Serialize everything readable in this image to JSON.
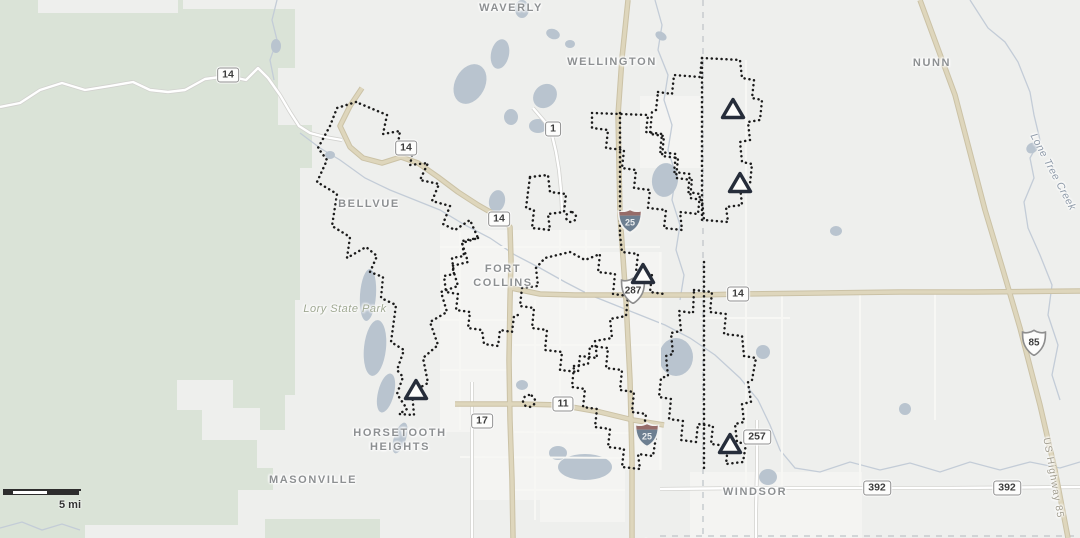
{
  "map": {
    "colors": {
      "background": "#eeefed",
      "green": "#dae3d7",
      "urban": "#f4f4f2",
      "water": "#b9c4cf",
      "creek": "#c3ccd7",
      "road_major_fill": "#ded6bc",
      "road_major_casing": "#cbc2a6",
      "road_white_fill": "#ffffff",
      "road_white_casing": "#d2d2cf",
      "road_faint": "#f7f7f4",
      "boundary_dots": "#1b1b1b",
      "county_line": "#c7cbcf",
      "marker_stroke": "#262d3a",
      "marker_fill": "#fcfcfa",
      "interstate_red": "#966c69",
      "interstate_blue": "#6d7f91"
    },
    "places": [
      {
        "text": "WAVERLY",
        "x": 511,
        "y": 8,
        "kind": "town"
      },
      {
        "text": "WELLINGTON",
        "x": 612,
        "y": 62,
        "kind": "town"
      },
      {
        "text": "NUNN",
        "x": 932,
        "y": 63,
        "kind": "town"
      },
      {
        "text": "BELLVUE",
        "x": 369,
        "y": 204,
        "kind": "town"
      },
      {
        "text": "FORT COLLINS",
        "x": 503,
        "y": 276,
        "kind": "town",
        "lines": [
          "FORT",
          "COLLINS"
        ]
      },
      {
        "text": "Lory State Park",
        "x": 345,
        "y": 309,
        "kind": "park"
      },
      {
        "text": "HORSETOOTH HEIGHTS",
        "x": 400,
        "y": 440,
        "kind": "town",
        "lines": [
          "HORSETOOTH",
          "HEIGHTS"
        ]
      },
      {
        "text": "MASONVILLE",
        "x": 313,
        "y": 480,
        "kind": "town"
      },
      {
        "text": "WINDSOR",
        "x": 755,
        "y": 492,
        "kind": "town"
      },
      {
        "text": "Lone Tree Creek",
        "x": 1053,
        "y": 172,
        "kind": "water",
        "rot": 62
      },
      {
        "text": "US Highway 85",
        "x": 1053,
        "y": 478,
        "kind": "road",
        "rot": 80
      }
    ],
    "shields": [
      {
        "type": "state",
        "label": "14",
        "x": 228,
        "y": 75
      },
      {
        "type": "state",
        "label": "14",
        "x": 406,
        "y": 148
      },
      {
        "type": "state",
        "label": "14",
        "x": 499,
        "y": 219
      },
      {
        "type": "state",
        "label": "14",
        "x": 738,
        "y": 294
      },
      {
        "type": "state",
        "label": "1",
        "x": 553,
        "y": 129
      },
      {
        "type": "state",
        "label": "17",
        "x": 482,
        "y": 421
      },
      {
        "type": "state",
        "label": "11",
        "x": 563,
        "y": 404
      },
      {
        "type": "state",
        "label": "257",
        "x": 757,
        "y": 437
      },
      {
        "type": "state",
        "label": "392",
        "x": 877,
        "y": 488
      },
      {
        "type": "state",
        "label": "392",
        "x": 1007,
        "y": 488
      },
      {
        "type": "us",
        "label": "287",
        "x": 619,
        "y": 276
      },
      {
        "type": "us",
        "label": "85",
        "x": 1020,
        "y": 328
      },
      {
        "type": "interstate",
        "label": "25",
        "x": 616,
        "y": 207
      },
      {
        "type": "interstate",
        "label": "25",
        "x": 633,
        "y": 421
      },
      {
        "type": "interstate",
        "label": "25",
        "x": 632,
        "y": 536
      }
    ],
    "markers": [
      {
        "x": 720,
        "y": 97
      },
      {
        "x": 727,
        "y": 171
      },
      {
        "x": 630,
        "y": 262
      },
      {
        "x": 403,
        "y": 378
      },
      {
        "x": 717,
        "y": 432
      }
    ],
    "green_areas": [
      {
        "points": "0,0 295,0 295,68 278,68 278,125 312,125 312,168 300,168 300,300 295,300 295,395 285,395 285,430 257,430 257,468 273,468 273,490 238,490 238,525 85,525 85,538 0,538"
      },
      {
        "points": "265,519 380,519 380,538 265,538"
      }
    ],
    "gray_patches": [
      {
        "x": 38,
        "y": 0,
        "w": 140,
        "h": 13
      },
      {
        "x": 183,
        "y": 0,
        "w": 112,
        "h": 9
      },
      {
        "x": 177,
        "y": 380,
        "w": 56,
        "h": 30
      },
      {
        "x": 202,
        "y": 408,
        "w": 58,
        "h": 32
      }
    ],
    "urban_areas": [
      {
        "points": "440,230 600,230 600,252 662,252 662,470 625,470 625,522 540,522 540,500 470,500 470,432 440,432"
      },
      {
        "points": "640,96 700,96 700,168 640,168"
      },
      {
        "points": "690,472 862,472 862,538 690,538"
      }
    ],
    "water": [
      [
        500,
        54,
        9,
        15,
        12
      ],
      [
        522,
        9,
        7,
        9,
        0
      ],
      [
        470,
        84,
        15,
        21,
        28
      ],
      [
        545,
        96,
        11,
        13,
        42
      ],
      [
        511,
        117,
        7,
        8,
        0
      ],
      [
        538,
        126,
        9,
        7,
        0
      ],
      [
        553,
        34,
        7,
        5,
        20
      ],
      [
        570,
        44,
        5,
        4,
        0
      ],
      [
        497,
        201,
        8,
        11,
        12
      ],
      [
        368,
        295,
        8,
        26,
        4
      ],
      [
        375,
        348,
        11,
        28,
        6
      ],
      [
        386,
        393,
        8,
        20,
        14
      ],
      [
        400,
        438,
        6,
        16,
        18
      ],
      [
        665,
        180,
        13,
        17,
        8
      ],
      [
        676,
        357,
        17,
        19,
        0
      ],
      [
        763,
        352,
        7,
        7,
        0
      ],
      [
        522,
        385,
        6,
        5,
        0
      ],
      [
        585,
        467,
        27,
        13,
        0
      ],
      [
        558,
        453,
        9,
        7,
        0
      ],
      [
        768,
        477,
        9,
        8,
        0
      ],
      [
        905,
        409,
        6,
        6,
        0
      ],
      [
        836,
        231,
        6,
        5,
        0
      ],
      [
        1032,
        148,
        5,
        6,
        55
      ],
      [
        276,
        46,
        5,
        7,
        0
      ],
      [
        661,
        36,
        6,
        4,
        30
      ],
      [
        330,
        155,
        5,
        4,
        0
      ]
    ],
    "creeks": [
      {
        "pts": "970,0 988,28 1005,42 1018,62 1030,92 1034,115 1040,140 1030,158 1034,178 1024,202 1028,228 1040,255 1052,285 1048,315 1058,345 1052,375 1060,400"
      },
      {
        "pts": "655,0 662,25 658,50 668,75 664,100 672,125 668,150 676,175 672,200 680,225 676,250 684,275 680,300"
      },
      {
        "pts": "300,133 320,148 340,160 365,178 390,190 415,200 440,210 465,225 490,238 515,255 540,268 565,282 590,295 615,305 640,315 665,325 690,338 715,355 740,378 758,400 770,425 780,450 795,468 820,472 850,462 880,470 910,463 940,472 970,462 1000,470 1030,462 1060,468 1080,462"
      },
      {
        "pts": "277,0 272,20 277,40 270,60 274,80"
      },
      {
        "pts": "0,528 22,522 42,530 62,524 80,530"
      }
    ],
    "roads": [
      {
        "style": "faint",
        "pts": "460,232 460,430"
      },
      {
        "style": "faint",
        "pts": "535,300 535,520"
      },
      {
        "style": "faint",
        "pts": "560,230 560,402"
      },
      {
        "style": "faint",
        "pts": "586,230 586,310"
      },
      {
        "style": "faint",
        "pts": "660,252 660,470"
      },
      {
        "style": "faint",
        "pts": "440,247 660,247"
      },
      {
        "style": "faint",
        "pts": "440,320 508,320"
      },
      {
        "style": "faint",
        "pts": "514,345 660,345"
      },
      {
        "style": "faint",
        "pts": "440,370 508,370"
      },
      {
        "style": "faint",
        "pts": "514,432 630,433"
      },
      {
        "style": "faint",
        "pts": "460,457 630,458"
      },
      {
        "style": "faint",
        "pts": "514,490 625,490"
      },
      {
        "style": "faint",
        "pts": "746,60 746,290"
      },
      {
        "style": "faint",
        "pts": "746,300 746,486"
      },
      {
        "style": "faint",
        "pts": "782,296 782,486"
      },
      {
        "style": "faint",
        "pts": "860,293 860,486"
      },
      {
        "style": "faint",
        "pts": "700,318 790,318"
      },
      {
        "style": "faint",
        "pts": "935,293 935,420"
      },
      {
        "style": "white",
        "pts": "0,107 20,103 40,90 62,83 85,90 110,86 133,82 150,90 168,92 185,90 205,79 228,76 246,80 258,68 268,78 280,95 290,112 299,126 310,133 325,137 342,140"
      },
      {
        "style": "white",
        "pts": "533,108 545,122 552,135 556,152 559,170 561,190 562,210"
      },
      {
        "style": "white",
        "pts": "472,382 472,538"
      },
      {
        "style": "white",
        "pts": "757,420 757,470 756,510 756,538"
      },
      {
        "style": "white",
        "pts": "660,489 750,488 850,488 950,488 1080,487"
      },
      {
        "style": "tan",
        "pts": "628,0 622,58 618,115 619,165 620,215 626,300 630,380 632,460 632,538"
      },
      {
        "style": "tan",
        "pts": "362,88 350,106 340,126 350,147 363,158 382,163 401,157 418,163 438,177 458,192 478,205 499,217 510,227 511,260 510,300 509,360 510,420 512,480 513,538"
      },
      {
        "style": "tan",
        "pts": "511,288 540,294 575,295 620,295 700,295 740,294 900,292 975,292 1080,291"
      },
      {
        "style": "tan",
        "pts": "455,404 520,404 560,405 600,412 633,420 664,425"
      },
      {
        "style": "tan",
        "pts": "920,0 955,95 985,210 1003,270 1020,328 1040,405 1055,470 1068,538"
      }
    ],
    "county_lines": [
      {
        "d": "M703,0 L703,538"
      },
      {
        "d": "M660,536 L1080,536"
      }
    ],
    "boundaries": [
      {
        "d": "M356,102 L337,108 L330,126 L318,148 L327,160 L317,182 L337,194 L332,226 L350,237 L347,258 L366,247 L377,256 L370,272 L383,277 L381,298 L396,305 L391,342 L404,350 L397,370 L403,377 L397,394 L407,409 L399,414 L414,415 L412,392 L428,383 L423,358 L438,345 L430,322 L447,312 L441,292 L458,286 L452,266 L468,262 L462,243 L478,238 L470,220 L455,230 L443,224 L450,206 L432,201 L439,184 L420,180 L428,163 L410,165 L414,146 L397,150 L400,131 L383,134 L387,115 Z"
      },
      {
        "d": "M478,238 L462,241 L464,256 L452,258 L454,274 L444,276 L446,292 L458,294 L456,310 L470,312 L468,328 L482,330 L484,344 L498,346 L500,330 L512,332 L514,316 L522,314"
      },
      {
        "d": "M530,177 L548,175 L550,192 L566,194 L564,212 L548,214 L550,230 L532,228 L534,210 L526,208 L528,192 Z"
      },
      {
        "d": "M571,212 a5,5 0 1 0 0.01,0 Z"
      },
      {
        "d": "M592,113 L648,115 L646,132 L662,134 L660,152 L676,154 L674,172 L690,174 L688,192 L700,194 L698,214 L680,212 L682,230 L664,228 L666,210 L648,208 L650,190 L634,188 L636,170 L622,168 L624,150 L606,148 L608,130 L592,128 Z"
      },
      {
        "d": "M620,113 L620,235"
      },
      {
        "d": "M620,235 L622,252 L638,254 L636,272 L652,274 L650,292 L664,294"
      },
      {
        "d": "M658,92 L672,94 L674,75 L700,77 L702,58 L740,60 L742,78 L754,80 L752,98 L762,100 L760,120 L748,122 L750,140 L740,142 L742,162 L752,164 L750,184 L740,186 L742,205 L726,207 L728,222 L704,220 L702,200 L690,198 L692,180 L676,178 L678,158 L662,156 L664,136 L650,134 L652,112 L656,110 Z"
      },
      {
        "d": "M702,58 L702,222"
      },
      {
        "d": "M694,290 L712,292 L710,312 L726,314 L724,334 L742,336 L744,356 L756,358 L752,380 L748,382 L751,402 L742,404 L744,422 L735,424 L737,442 L746,444 L743,462 L726,464 L728,446 L711,444 L713,426 L698,424 L696,442 L681,440 L683,421 L669,419 L671,399 L659,397 L661,378 L668,376 L666,356 L673,354 L671,333 L681,331 L679,311 L693,313 Z"
      },
      {
        "d": "M704,262 L704,468"
      },
      {
        "d": "M522,288 L538,286 L536,268 L545,258 L570,252 L585,260 L600,254 L598,272 L615,274 L613,294 L628,296 L626,316 L610,319 L612,338 L595,341 L597,358 L580,356 L578,372 L560,370 L562,352 L545,350 L547,330 L532,328 L534,308 L520,306 Z"
      },
      {
        "d": "M574,366 L588,364 L590,346 L608,348 L606,368 L622,370 L620,390 L634,392 L632,412 L646,414 L643,435 L656,437 L653,456 L638,454 L640,469 L622,467 L624,449 L608,447 L610,429 L595,427 L597,409 L583,407 L585,389 L572,387 Z"
      },
      {
        "d": "M529,395 a6,6 0 1 0 0.01,0 Z"
      }
    ],
    "scalebar": {
      "label": "5 mi",
      "segments": [
        "dark",
        "light",
        "dark"
      ]
    }
  }
}
